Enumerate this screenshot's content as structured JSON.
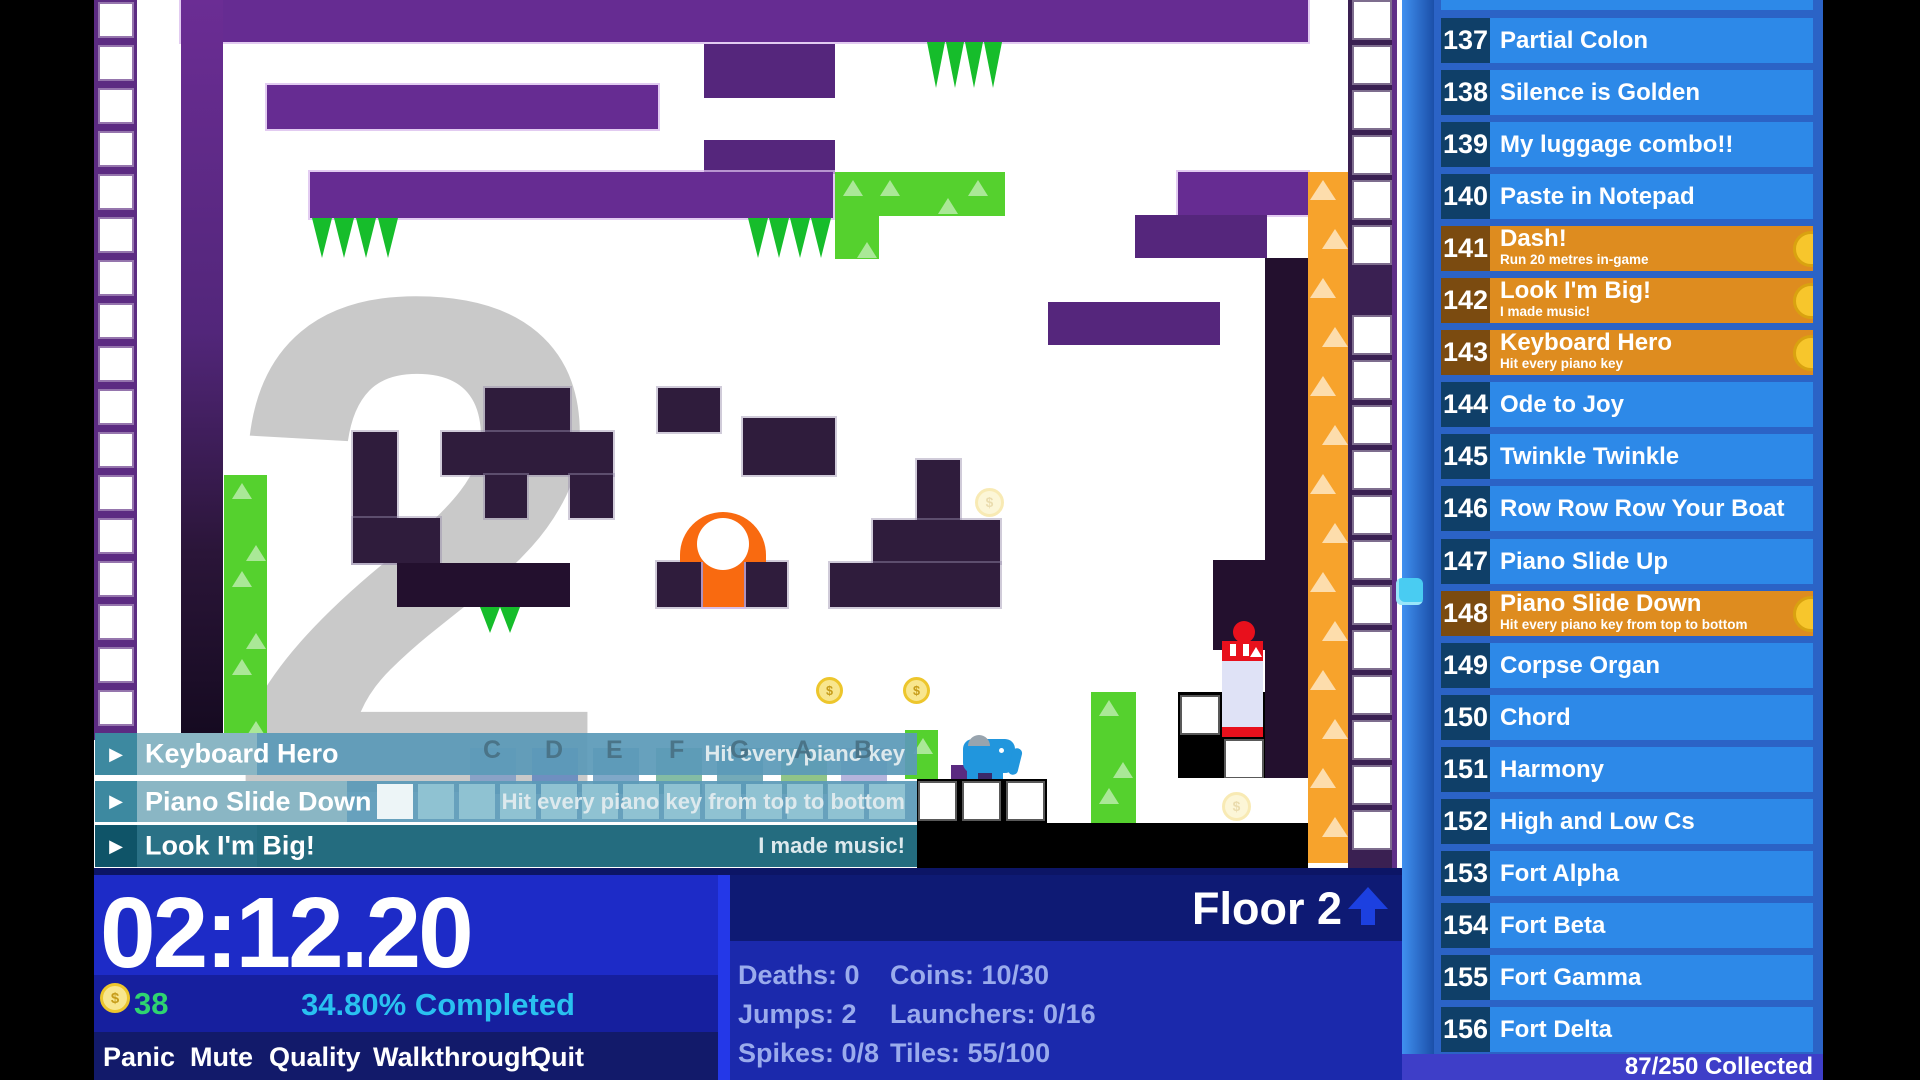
{
  "colors": {
    "row_locked": "#2d89e8",
    "row_locked_num": "#0f3f68",
    "row_unlocked": "#de8c1f",
    "row_unlocked_num": "#7b4b10",
    "banner_teal": "#5b9ab8",
    "banner_teal_dark": "#186478",
    "accent_green": "#2fd470",
    "accent_cyan": "#29c1f0",
    "purple_bright": "#662c92",
    "purple_dark": "#2f1c3c",
    "spike_green": "#16bd2b",
    "launcher_orange": "#f7a32c",
    "player_orange": "#f96a10",
    "elephant_blue": "#2196dd",
    "machine_red": "#e8101c"
  },
  "sidebar": {
    "rows": [
      {
        "num": "137",
        "title": "Partial Colon",
        "sub": "",
        "unlocked": false
      },
      {
        "num": "138",
        "title": "Silence is Golden",
        "sub": "",
        "unlocked": false
      },
      {
        "num": "139",
        "title": "My luggage combo!!",
        "sub": "",
        "unlocked": false
      },
      {
        "num": "140",
        "title": "Paste in Notepad",
        "sub": "",
        "unlocked": false
      },
      {
        "num": "141",
        "title": "Dash!",
        "sub": "Run 20 metres in-game",
        "unlocked": true
      },
      {
        "num": "142",
        "title": "Look I'm Big!",
        "sub": "I made music!",
        "unlocked": true
      },
      {
        "num": "143",
        "title": "Keyboard Hero",
        "sub": "Hit every piano key",
        "unlocked": true
      },
      {
        "num": "144",
        "title": "Ode to Joy",
        "sub": "",
        "unlocked": false
      },
      {
        "num": "145",
        "title": "Twinkle Twinkle",
        "sub": "",
        "unlocked": false
      },
      {
        "num": "146",
        "title": "Row Row Row Your Boat",
        "sub": "",
        "unlocked": false
      },
      {
        "num": "147",
        "title": "Piano Slide Up",
        "sub": "",
        "unlocked": false
      },
      {
        "num": "148",
        "title": "Piano Slide Down",
        "sub": "Hit every piano key from top to bottom",
        "unlocked": true
      },
      {
        "num": "149",
        "title": "Corpse Organ",
        "sub": "",
        "unlocked": false
      },
      {
        "num": "150",
        "title": "Chord",
        "sub": "",
        "unlocked": false
      },
      {
        "num": "151",
        "title": "Harmony",
        "sub": "",
        "unlocked": false
      },
      {
        "num": "152",
        "title": "High and Low Cs",
        "sub": "",
        "unlocked": false
      },
      {
        "num": "153",
        "title": "Fort Alpha",
        "sub": "",
        "unlocked": false
      },
      {
        "num": "154",
        "title": "Fort Beta",
        "sub": "",
        "unlocked": false
      },
      {
        "num": "155",
        "title": "Fort Gamma",
        "sub": "",
        "unlocked": false
      },
      {
        "num": "156",
        "title": "Fort Delta",
        "sub": "",
        "unlocked": false
      }
    ],
    "footer": "87/250 Collected"
  },
  "notifications": [
    {
      "title": "Keyboard Hero",
      "desc": "Hit every piano key"
    },
    {
      "title": "Piano Slide Down",
      "desc": "Hit every piano key from top to bottom"
    },
    {
      "title": "Look I'm Big!",
      "desc": "I made music!"
    }
  ],
  "piano": {
    "letters": [
      "C",
      "D",
      "E",
      "F",
      "G",
      "A",
      "B"
    ]
  },
  "hud": {
    "timer": "02:12.20",
    "coin_count": "38",
    "completed": "34.80% Completed",
    "menu_items": [
      "Panic",
      "Mute",
      "Quality",
      "Walkthrough",
      "Quit"
    ],
    "floor_label": "Floor 2",
    "level_number": "2",
    "coin_symbol": "$"
  },
  "stats": {
    "left": [
      {
        "label": "Deaths:",
        "value": "0"
      },
      {
        "label": "Jumps:",
        "value": "2"
      },
      {
        "label": "Spikes:",
        "value": "0/8"
      }
    ],
    "right": [
      {
        "label": "Coins:",
        "value": "10/30"
      },
      {
        "label": "Launchers:",
        "value": "0/16"
      },
      {
        "label": "Tiles:",
        "value": "55/100"
      }
    ]
  }
}
